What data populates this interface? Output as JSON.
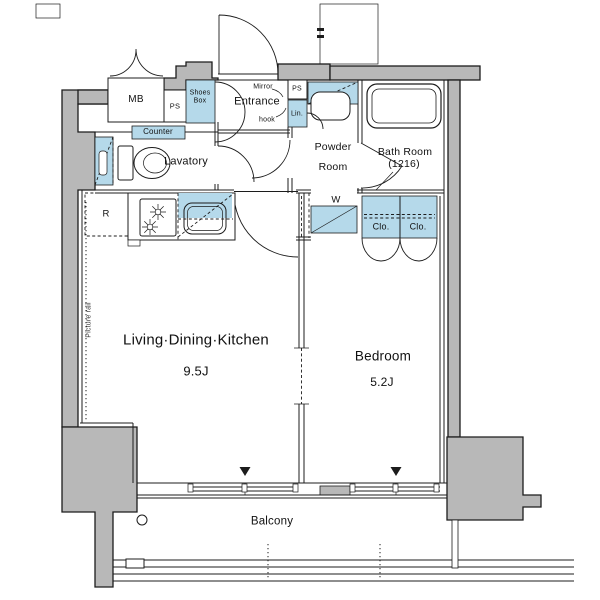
{
  "plan": {
    "rooms": {
      "living_dining_kitchen": {
        "name": "Living·Dining·Kitchen",
        "size": "9.5J"
      },
      "bedroom": {
        "name": "Bedroom",
        "size": "5.2J"
      },
      "entrance": {
        "name": "Entrance"
      },
      "lavatory": {
        "name": "Lavatory"
      },
      "powder_room": {
        "line1": "Powder",
        "line2": "Room"
      },
      "bath_room": {
        "name": "Bath Room",
        "size": "(1216)"
      },
      "balcony": {
        "name": "Balcony"
      }
    },
    "fixtures": {
      "meter_box": "MB",
      "pipe_space_left": "PS",
      "pipe_space_right": "PS",
      "shoes_box": {
        "line1": "Shoes",
        "line2": "Box"
      },
      "counter": "Counter",
      "linen": "Lin.",
      "mirror": "Mirror",
      "hook": "hook",
      "refrigerator": "R",
      "washing_machine": "W",
      "closet_left": "Clo.",
      "closet_right": "Clo.",
      "picture_rail": "Picture rail"
    },
    "colors": {
      "wall": "#b8b8b8",
      "highlight": "#b5d9ea",
      "line": "#1c1c1c",
      "background": "#ffffff"
    }
  }
}
